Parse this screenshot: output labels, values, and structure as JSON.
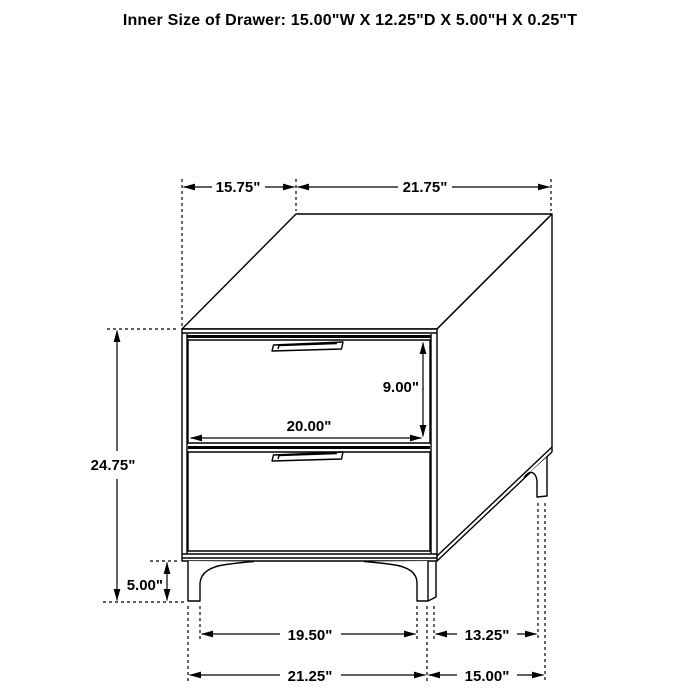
{
  "title": "Inner Size of Drawer: 15.00\"W X 12.25\"D X 5.00\"H X 0.25\"T",
  "colors": {
    "line": "#000000",
    "background": "#ffffff",
    "text": "#000000"
  },
  "diagram": {
    "type": "furniture-dimension-drawing",
    "subject": "two-drawer nightstand, isometric line drawing",
    "labels": {
      "top_depth": "15.75\"",
      "top_width": "21.75\"",
      "overall_height": "24.75\"",
      "drawer_front_height": "9.00\"",
      "drawer_front_width": "20.00\"",
      "leg_height": "5.00\"",
      "base_front_inner_span": "19.50\"",
      "base_side_inner_span": "13.25\"",
      "base_front_outer_span": "21.25\"",
      "base_side_outer_span": "15.00\""
    }
  }
}
